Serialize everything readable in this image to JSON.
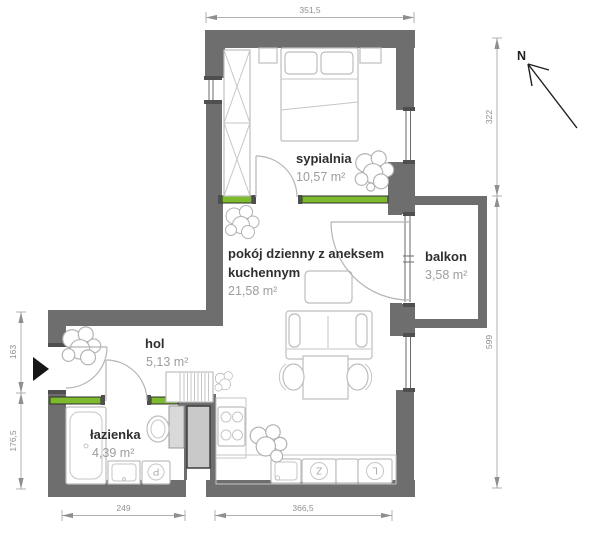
{
  "rooms": {
    "sypialnia": {
      "name": "sypialnia",
      "area": "10,57 m²"
    },
    "pokoj_dzienny": {
      "name_line1": "pokój dzienny z aneksem",
      "name_line2": "kuchennym",
      "area": "21,58 m²"
    },
    "balkon": {
      "name": "balkon",
      "area": "3,58 m²"
    },
    "hol": {
      "name": "hol",
      "area": "5,13 m²"
    },
    "lazienka": {
      "name": "łazienka",
      "area": "4,39 m²"
    }
  },
  "dimensions_cm": {
    "top_width": "351,5",
    "right_bedroom_height": "322",
    "right_total_height": "599",
    "bottom_bathroom_width": "249",
    "bottom_main_width": "366,5",
    "left_hall_height": "163",
    "left_bathroom_height": "176,5"
  },
  "compass": {
    "north_label": "N"
  },
  "appliance_labels": {
    "dishwasher": "Z",
    "fridge": "L",
    "washer": "P"
  },
  "colors": {
    "wall": "#6e6e6e",
    "accent_green": "#7dba2e",
    "dimension_gray": "#8f8f8f",
    "room_label": "#2f2f2f",
    "area_label": "#9d9d9d"
  }
}
